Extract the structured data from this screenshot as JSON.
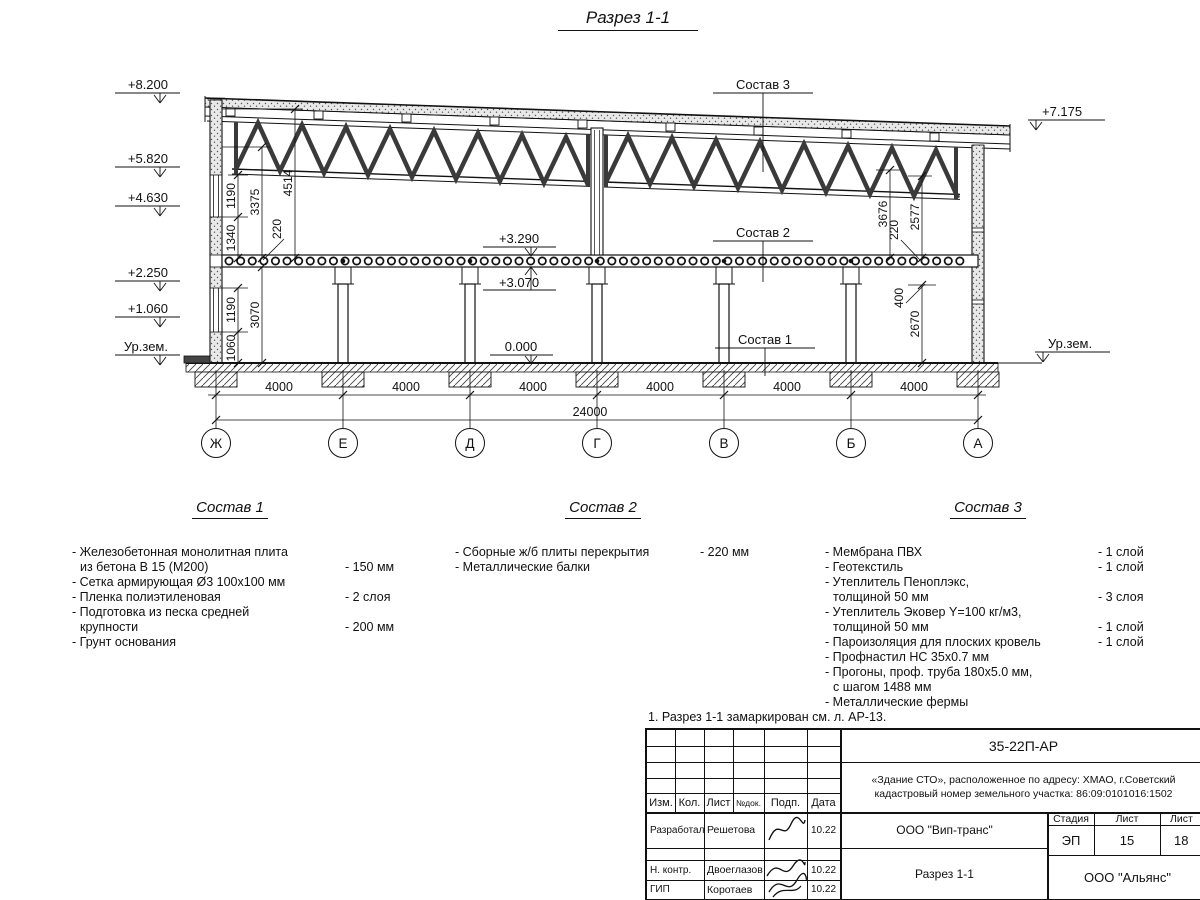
{
  "title": "Разрез 1-1",
  "drawing": {
    "marks_left": [
      "+8.200",
      "+5.820",
      "+4.630",
      "+2.250",
      "+1.060",
      "Ур.зем."
    ],
    "marks_right_top": "+7.175",
    "marks_right_ground": "Ур.зем.",
    "marks_mid": [
      "+3.290",
      "+3.070",
      "0.000"
    ],
    "callouts": [
      "Состав 3",
      "Состав 2",
      "Состав 1"
    ],
    "dims": {
      "left_upper": [
        "1190",
        "1340",
        "3375",
        "4514",
        "220"
      ],
      "left_lower": [
        "1190",
        "1060",
        "3070"
      ],
      "right_upper": [
        "3676",
        "2577",
        "220"
      ],
      "right_lower": [
        "400",
        "2670"
      ],
      "spans": [
        "4000",
        "4000",
        "4000",
        "4000",
        "4000",
        "4000"
      ],
      "total": "24000"
    },
    "axes": [
      "Ж",
      "Е",
      "Д",
      "Г",
      "В",
      "Б",
      "А"
    ]
  },
  "compositions": [
    {
      "title": "Состав 1",
      "items": [
        {
          "l1": "- Железобетонная  монолитная плита",
          "l2": "из бетона В 15 (М200)",
          "value": "- 150 мм"
        },
        {
          "l1": "- Сетка армирующая Ø3 100x100 мм"
        },
        {
          "l1": "- Пленка полиэтиленовая",
          "value": "-  2 слоя"
        },
        {
          "l1": "- Подготовка из песка средней",
          "l2": "крупности",
          "value": "- 200 мм"
        },
        {
          "l1": "- Грунт основания"
        }
      ]
    },
    {
      "title": "Состав 2",
      "items": [
        {
          "l1": "- Сборные ж/б плиты перекрытия",
          "value": "- 220 мм"
        },
        {
          "l1": "- Металлические балки"
        }
      ]
    },
    {
      "title": "Состав 3",
      "items": [
        {
          "l1": "- Мембрана ПВХ",
          "value": "- 1 слой"
        },
        {
          "l1": "- Геотекстиль",
          "value": "- 1 слой"
        },
        {
          "l1": "- Утеплитель Пеноплэкс,",
          "l2": "толщиной 50 мм",
          "value": "- 3 слоя"
        },
        {
          "l1": "- Утеплитель Эковер Y=100 кг/м3,",
          "l2": "толщиной 50 мм",
          "value": "- 1 слой"
        },
        {
          "l1": "- Пароизоляция для плоских кровель",
          "value": "- 1 слой"
        },
        {
          "l1": "- Профнастил НС 35x0.7 мм"
        },
        {
          "l1": "- Прогоны, проф. труба 180x5.0 мм,",
          "l2": "с шагом 1488 мм"
        },
        {
          "l1": "- Металлические фермы"
        }
      ]
    }
  ],
  "note": "1. Разрез 1-1 замаркирован см. л. АР-13.",
  "titleblock": {
    "doc_number": "35-22П-АР",
    "object_line1": "«Здание СТО», расположенное по адресу: ХМАО, г.Советский",
    "object_line2": "кадастровый номер земельного участка: 86:09:0101016:1502",
    "cols": [
      "Изм.",
      "Кол.",
      "Лист",
      "№док.",
      "Подп.",
      "Дата"
    ],
    "rows": [
      {
        "role": "Разработал",
        "name": "Решетова",
        "date": "10.22"
      },
      {
        "role": "Н. контр.",
        "name": "Двоеглазов",
        "date": "10.22"
      },
      {
        "role": "ГИП",
        "name": "Коротаев",
        "date": "10.22"
      }
    ],
    "org_mid": "ООО \"Вип-транс\"",
    "stage_label": "Стадия",
    "sheet_label": "Лист",
    "sheets_label": "Лист",
    "stage": "ЭП",
    "sheet": "15",
    "sheets": "18",
    "drawing_name": "Разрез 1-1",
    "org_bottom": "ООО \"Альянс\""
  }
}
